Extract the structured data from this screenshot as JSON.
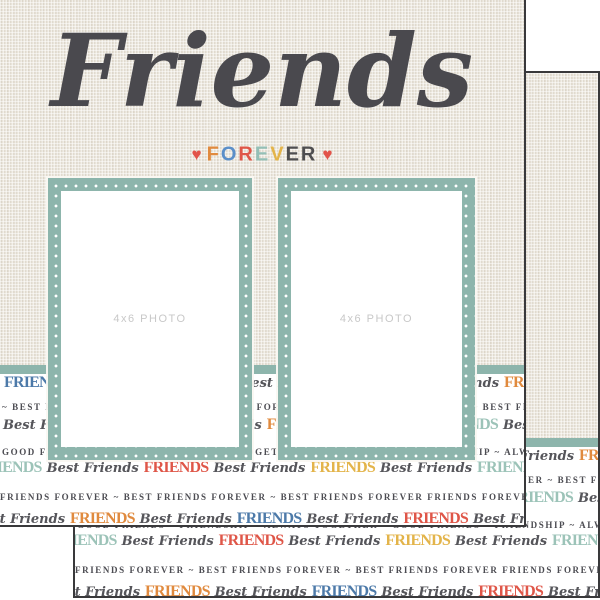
{
  "title": {
    "text": "Friends",
    "color": "#4a494e"
  },
  "subtitle": {
    "heart": "♥",
    "heart_color": "#e2544a",
    "letters": [
      {
        "ch": "F",
        "color": "#e08a3e"
      },
      {
        "ch": "O",
        "color": "#5b8fc9"
      },
      {
        "ch": "R",
        "color": "#df5648"
      },
      {
        "ch": "E",
        "color": "#94bfb6"
      },
      {
        "ch": "V",
        "color": "#e3b44a"
      },
      {
        "ch": "E",
        "color": "#4e4e50"
      },
      {
        "ch": "R",
        "color": "#4e4e50"
      }
    ]
  },
  "frames": {
    "label": "4x6 PHOTO",
    "label_color": "#c8c8c8",
    "border_color": "#8db5ac",
    "dot_color": "#ffffff"
  },
  "paper": {
    "texture_color": "#e9e4da",
    "strip_bg": "#ffffff",
    "divider_color": "#8db5ac",
    "edge_color": "#39393b",
    "text_colors": {
      "blue": "#4d7aa9",
      "coral": "#df5648",
      "orange": "#e08a3e",
      "yellow": "#e3b44a",
      "teal": "#9cc3b8",
      "caps": "#4c4c52",
      "script": "#55555a"
    },
    "rows": [
      {
        "kind": "big",
        "top": 375,
        "offset": 2,
        "segments": [
          {
            "style": "blue",
            "text": "FRIENDS"
          },
          {
            "style": "script",
            "text": "Best Friends"
          },
          {
            "style": "yellow",
            "text": "FRIENDS"
          },
          {
            "style": "script",
            "text": "Best Friends"
          },
          {
            "style": "coral",
            "text": "FRIENDS"
          },
          {
            "style": "script",
            "text": "Best Friends"
          },
          {
            "style": "orange",
            "text": "FRIENDS"
          },
          {
            "style": "script",
            "text": "Best Friends"
          }
        ]
      },
      {
        "kind": "caps",
        "top": 403,
        "offset": 2,
        "text": "~ BEST FRIENDS FOREVER ~ BEST FRIENDS FOREVER ~ BEST FRIENDS FOREVER ~ BEST FRIENDS FOREVER ~ BEST"
      },
      {
        "kind": "big",
        "top": 417,
        "offset": 0,
        "segments": [
          {
            "style": "script",
            "text": "Best Friends"
          },
          {
            "style": "coral",
            "text": "FRIENDS"
          },
          {
            "style": "script",
            "text": "Best Friends"
          },
          {
            "style": "orange",
            "text": "FRIENDS"
          },
          {
            "style": "script",
            "text": "Best Friends"
          },
          {
            "style": "teal",
            "text": "FRIENDS"
          },
          {
            "style": "script",
            "text": "Best Friends"
          },
          {
            "style": "yellow",
            "text": "FRIENDS"
          }
        ]
      },
      {
        "kind": "caps",
        "top": 448,
        "offset": 2,
        "text": "GOOD FRIENDS ~ FRIENDSHIP ~ ALWAYS TOGETHER ~ GOOD FRIENDS ~ FRIENDSHIP ~ ALWAYS TOGETHER ~ GOOD"
      },
      {
        "kind": "big",
        "top": 460,
        "offset": -25,
        "segments": [
          {
            "style": "teal",
            "text": "FRIENDS"
          },
          {
            "style": "script",
            "text": "Best Friends"
          },
          {
            "style": "coral",
            "text": "FRIENDS"
          },
          {
            "style": "script",
            "text": "Best Friends"
          },
          {
            "style": "yellow",
            "text": "FRIENDS"
          },
          {
            "style": "script",
            "text": "Best Friends"
          },
          {
            "style": "teal",
            "text": "FRIENDS"
          },
          {
            "style": "script",
            "text": "Best Friends"
          },
          {
            "style": "coral",
            "text": "FRIENDS"
          }
        ]
      },
      {
        "kind": "caps",
        "top": 493,
        "offset": 0,
        "text": "FRIENDS FOREVER ~ BEST FRIENDS FOREVER ~ BEST FRIENDS FOREVER FRIENDS FOREVER ~ BEST FRIENDS FOREVER"
      },
      {
        "kind": "big",
        "top": 511,
        "offset": -30,
        "segments": [
          {
            "style": "script",
            "text": "Best Friends"
          },
          {
            "style": "orange",
            "text": "FRIENDS"
          },
          {
            "style": "script",
            "text": "Best Friends"
          },
          {
            "style": "blue",
            "text": "FRIENDS"
          },
          {
            "style": "script",
            "text": "Best Friends"
          },
          {
            "style": "coral",
            "text": "FRIENDS"
          },
          {
            "style": "script",
            "text": "Best Friends"
          },
          {
            "style": "orange",
            "text": "FRIENDS"
          }
        ]
      }
    ]
  }
}
